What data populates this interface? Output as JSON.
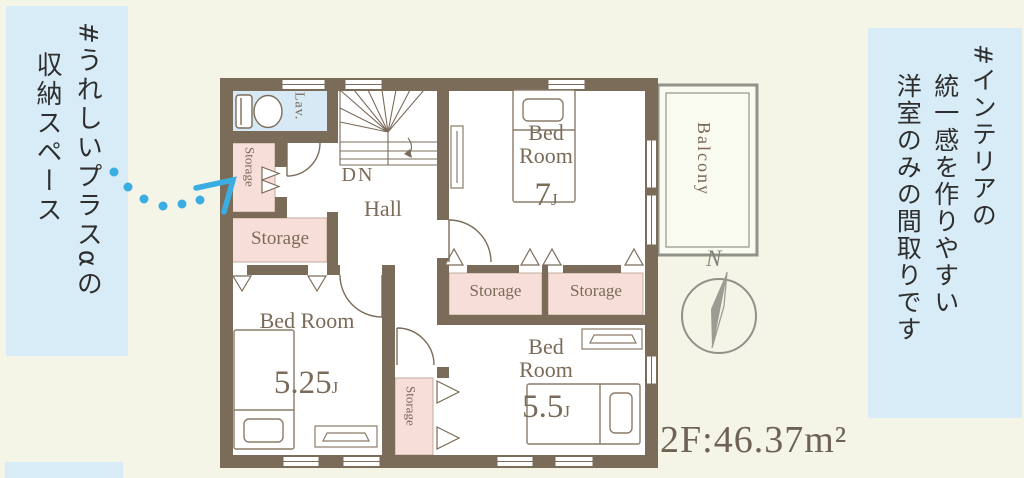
{
  "notes": {
    "left": {
      "lines": [
        "#うれしいプラスαの",
        "収納スペース"
      ]
    },
    "right": {
      "lines": [
        "#インテリアの",
        "統一感を作りやすい",
        "洋室のみの間取りです"
      ]
    }
  },
  "plan": {
    "area_label": "2F:46.37m²",
    "compass_n": "N",
    "rooms": {
      "lav": "Lav.",
      "hall": "Hall",
      "stairs_dn": "DN",
      "balcony": "Balcony",
      "storage_v1": "Storage",
      "storage_big": "Storage",
      "storage_a": "Storage",
      "storage_b": "Storage",
      "storage_v2": "Storage",
      "bed7": {
        "name": "Bed Room",
        "size": "7",
        "unit": "J"
      },
      "bed525": {
        "name": "Bed Room",
        "size": "5.25",
        "unit": "J"
      },
      "bed55": {
        "name": "Bed Room",
        "size": "5.5",
        "unit": "J"
      }
    },
    "colors": {
      "page_bg": "#f4f5e7",
      "note_bg": "#d8ecf7",
      "wall": "#7b6c5a",
      "storage_fill": "#f8ded9",
      "lav_fill": "#d6e9f4",
      "label": "#7a6a58",
      "accent_arrow": "#3aade2",
      "compass_gray": "#91918a"
    }
  }
}
